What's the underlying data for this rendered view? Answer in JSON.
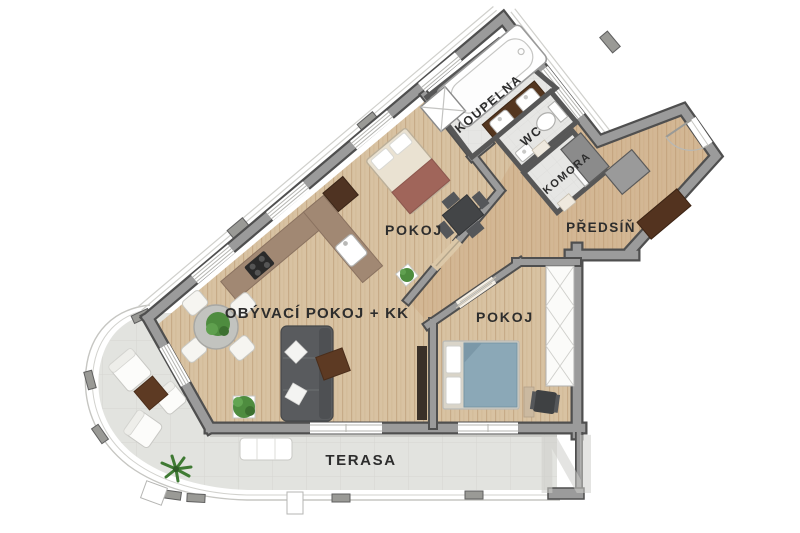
{
  "rooms": [
    {
      "name": "koupelna",
      "label": "KOUPELNA"
    },
    {
      "name": "wc",
      "label": "WC"
    },
    {
      "name": "komora",
      "label": "KOMORA"
    },
    {
      "name": "predsin",
      "label": "PŘEDSÍŇ"
    },
    {
      "name": "pokoj-1",
      "label": "POKOJ"
    },
    {
      "name": "obyvaci-pokoj-kk",
      "label": "OBÝVACÍ POKOJ + KK"
    },
    {
      "name": "pokoj-2",
      "label": "POKOJ"
    },
    {
      "name": "terasa",
      "label": "TERASA"
    }
  ],
  "watermark": "N",
  "colors": {
    "wall_fill": "#9b9b9b",
    "wall_outline": "#4f4f4f",
    "wood_floor": "#d8c2a2",
    "hall_tint": "#c49a6e",
    "tile_floor": "#e6e6e4",
    "terrace_floor": "#e2e3df",
    "sofa_gray": "#595b5e",
    "bed_blue": "#8ba8b7",
    "accent_brown": "#5d3a23",
    "plant_green": "#4e8c3f",
    "counter_brown": "#a1887360",
    "label_text": "#2d2d2d"
  },
  "furniture_icons": [
    "bathtub",
    "double-washbasin",
    "washing-machine",
    "toilet",
    "hand-basin",
    "storage-box",
    "hall-closet",
    "shoe-bench",
    "entrance-door-arc",
    "double-bed-beige",
    "desk-with-chairs",
    "potted-plant",
    "kitchen-counter",
    "cooktop",
    "kitchen-sink",
    "fridge",
    "dining-table-with-chairs",
    "corner-sofa",
    "coffee-table",
    "tv-board",
    "double-bed-blue",
    "office-chair",
    "built-in-wardrobe",
    "lounge-chair",
    "outdoor-coffee-table",
    "garden-bench",
    "palm-plant",
    "railing-post"
  ]
}
